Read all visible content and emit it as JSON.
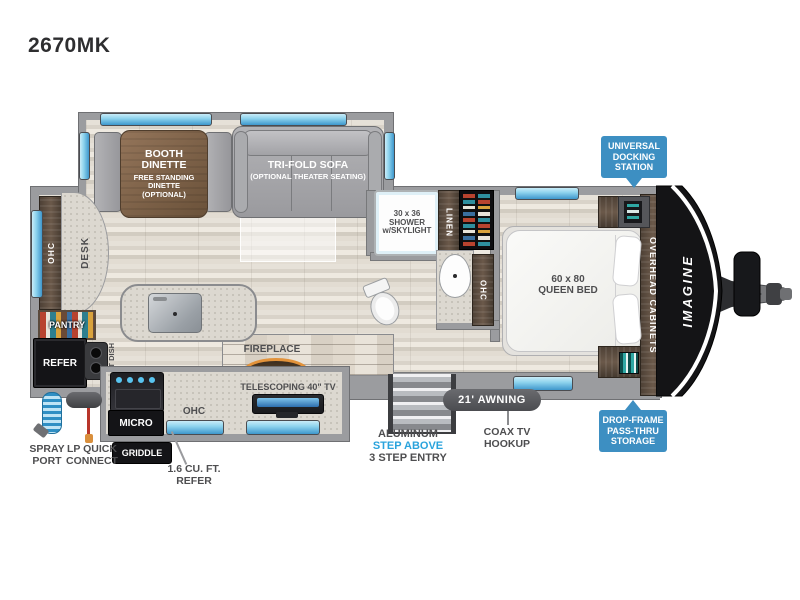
{
  "model": "2670MK",
  "brand": "IMAGINE",
  "colors": {
    "callout_blue": "#3d8fc2",
    "accent_blue": "#2aa3dc",
    "awning_gray": "#4b4c50",
    "label_dark": "#4e4e50",
    "window_light": "#c9ecf8",
    "window_deep": "#3e97cc",
    "fireplace_orange": "#e2923a",
    "teal_accent": "#2fa8a4"
  },
  "slide_room": {
    "dinette_title": "BOOTH\nDINETTE",
    "dinette_sub": "FREE STANDING\nDINETTE\n(OPTIONAL)",
    "sofa_title": "TRI-FOLD SOFA",
    "sofa_sub": "(OPTIONAL THEATER SEATING)"
  },
  "rear": {
    "ohc": "OHC",
    "desk": "DESK",
    "pantry": "PANTRY",
    "refer": "REFER",
    "pet_dish": "PET DISH"
  },
  "galley": {
    "micro": "MICRO",
    "ohc": "OHC",
    "griddle": "GRIDDLE",
    "fireplace": "FIREPLACE",
    "tv": "TELESCOPING 40\" TV"
  },
  "bath": {
    "shower": "30 x 36\nSHOWER\nw/SKYLIGHT",
    "linen": "LINEN",
    "ohc": "OHC"
  },
  "bedroom": {
    "bed": "60 x 80\nQUEEN BED",
    "overhead": "OVERHEAD CABINETS"
  },
  "callouts": {
    "docking": "UNIVERSAL\nDOCKING\nSTATION",
    "storage": "DROP-FRAME\nPASS-THRU\nSTORAGE",
    "awning": "21' AWNING",
    "coax": "COAX TV\nHOOKUP",
    "step_line1": "ALUMINUM",
    "step_line2": "STEP ABOVE",
    "step_line3": "3 STEP ENTRY",
    "spray": "SPRAY\nPORT",
    "lp": "LP QUICK\nCONNECT",
    "mini_refer": "1.6 CU. FT.\nREFER"
  }
}
